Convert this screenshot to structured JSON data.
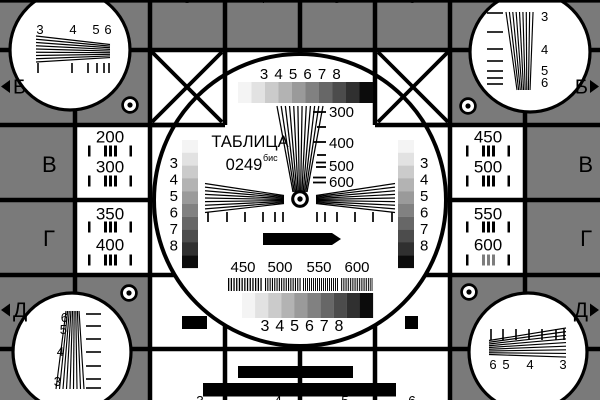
{
  "meta": {
    "title": "ТАБЛИЦА",
    "code": "0249",
    "code_suffix": "бис"
  },
  "colors": {
    "background_gray": "#7a7a7a",
    "line_black": "#000000",
    "field_white": "#ffffff",
    "grayscale_steps": [
      "#f4f4f4",
      "#e2e2e2",
      "#cbcbcb",
      "#b3b3b3",
      "#9a9a9a",
      "#818181",
      "#676767",
      "#4c4c4c",
      "#303030",
      "#0c0c0c"
    ]
  },
  "center_circle": {
    "top_scale_numbers": [
      "3",
      "4",
      "5",
      "6",
      "7",
      "8"
    ],
    "bottom_scale_numbers": [
      "3",
      "4",
      "5",
      "6",
      "7",
      "8"
    ],
    "left_scale_numbers": [
      "3",
      "4",
      "5",
      "6",
      "7",
      "8"
    ],
    "right_scale_numbers": [
      "3",
      "4",
      "5",
      "6",
      "7",
      "8"
    ],
    "vertical_wedge_labels": [
      "300",
      "400",
      "500",
      "600"
    ],
    "burst_labels": [
      "450",
      "500",
      "550",
      "600"
    ]
  },
  "side_panels": {
    "left_rows": [
      "200",
      "300",
      "350",
      "400"
    ],
    "right_rows": [
      "450",
      "500",
      "550",
      "600"
    ]
  },
  "corner_circles": {
    "top_left_numbers": [
      "3",
      "4",
      "5",
      "6"
    ],
    "top_right_numbers": [
      "3",
      "4",
      "5",
      "6"
    ],
    "bottom_left_numbers": [
      "6",
      "5",
      "4",
      "3"
    ],
    "bottom_right_numbers": [
      "6",
      "5",
      "4",
      "3"
    ]
  },
  "edge_labels": {
    "left_top": "Б",
    "right_top": "Б",
    "left_middle": "В",
    "right_middle": "В",
    "left_lower": "Г",
    "right_lower": "Г",
    "left_bottom": "Д",
    "right_bottom": "Д",
    "top_column_digits": [
      "3",
      "4",
      "5",
      "6"
    ],
    "bottom_column_digits": [
      "3",
      "4",
      "5",
      "6"
    ]
  }
}
